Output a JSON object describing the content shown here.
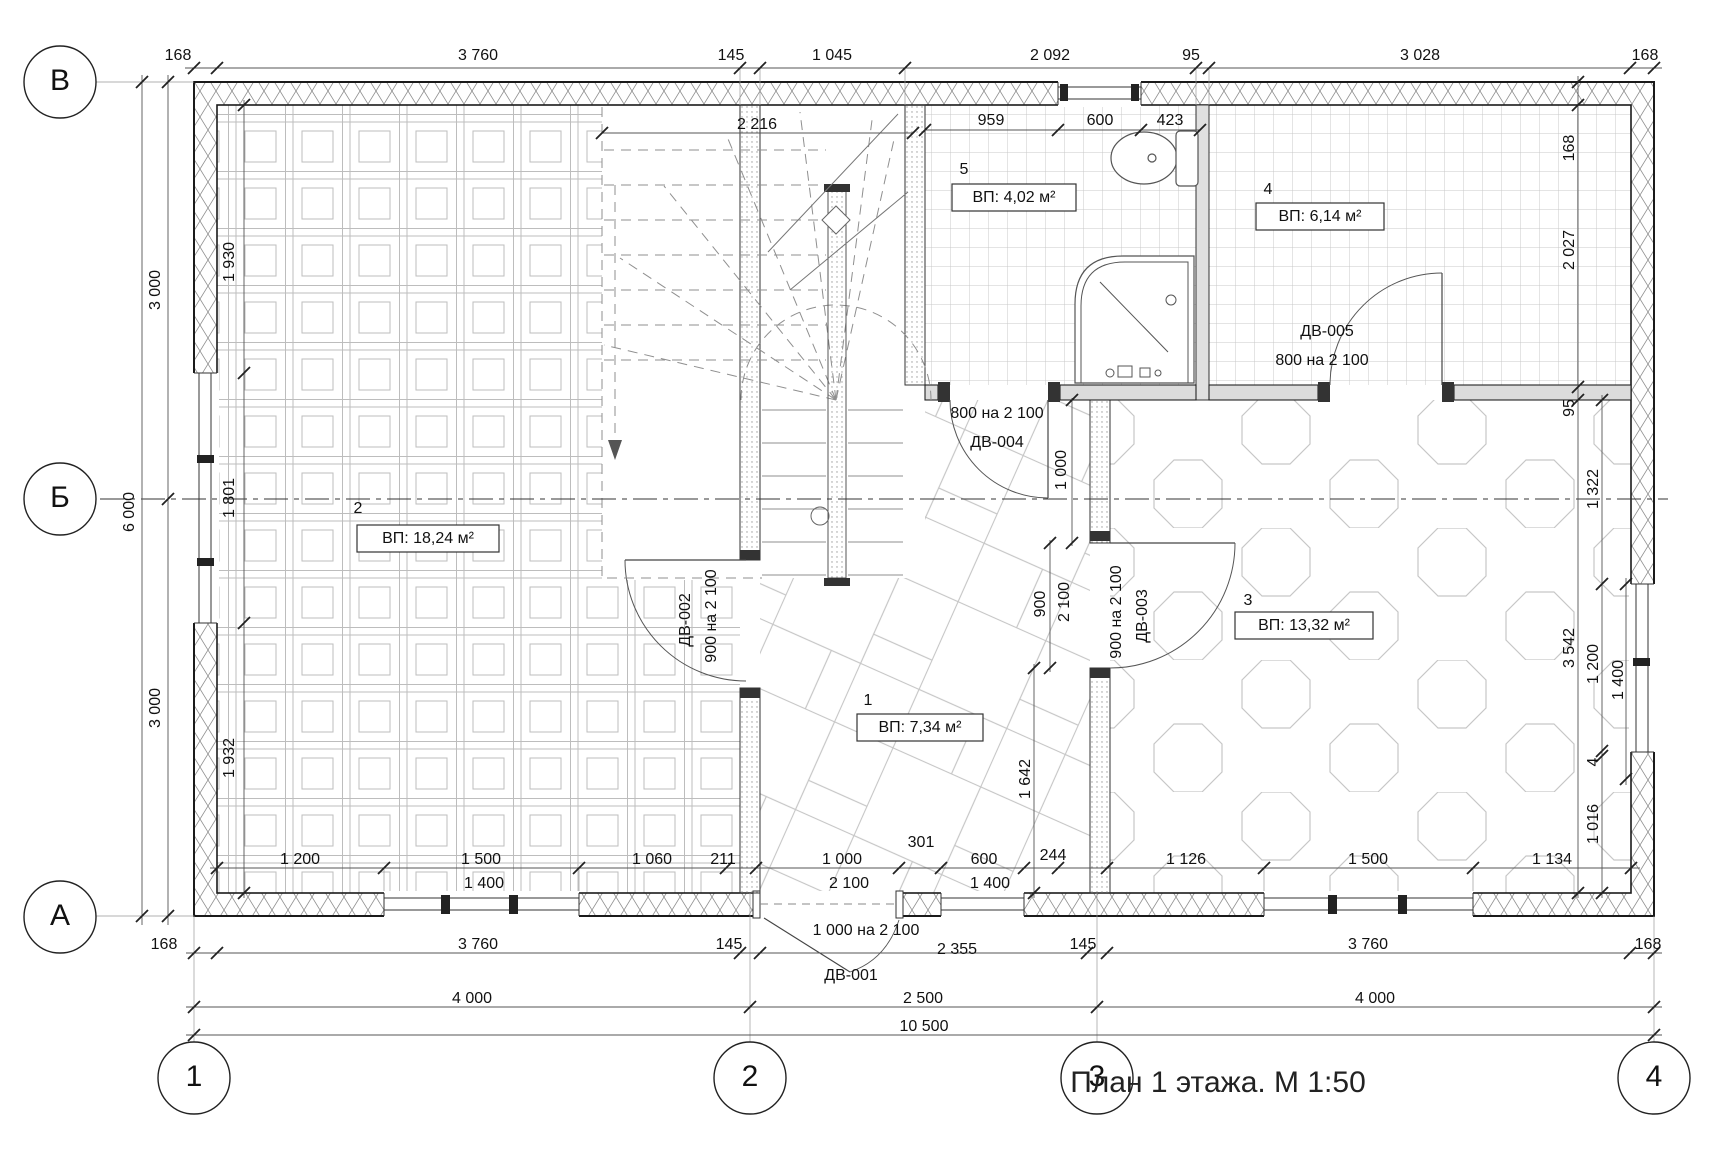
{
  "title": {
    "text": "План 1 этажа. М 1:50"
  },
  "grid": {
    "row_axes": [
      "В",
      "Б",
      "А"
    ],
    "col_axes": [
      "1",
      "2",
      "3",
      "4"
    ],
    "spans": {
      "1-2": "4 000",
      "2-3": "2 500",
      "3-4": "4 000",
      "total": "10 500",
      "В-Б": "3 000",
      "Б-А": "3 000",
      "В-А": "6 000"
    }
  },
  "rooms": [
    {
      "number": "1",
      "area": "ВП: 7,34 м²"
    },
    {
      "number": "2",
      "area": "ВП: 18,24 м²"
    },
    {
      "number": "3",
      "area": "ВП: 13,32 м²"
    },
    {
      "number": "4",
      "area": "ВП: 6,14 м²"
    },
    {
      "number": "5",
      "area": "ВП: 4,02 м²"
    }
  ],
  "doors": [
    {
      "id": "ДВ-001",
      "size": "1 000 на 2 100"
    },
    {
      "id": "ДВ-002",
      "size": "900 на 2 100"
    },
    {
      "id": "ДВ-003",
      "size": "900 на 2 100"
    },
    {
      "id": "ДВ-004",
      "size": "800 на 2 100"
    },
    {
      "id": "ДВ-005",
      "size": "800 на 2 100"
    }
  ],
  "colors": {
    "line": "#1a1a1a",
    "dim": "#555555",
    "pattern": "#c8c8c8",
    "wall_fill": "#dcdcdc"
  },
  "labels": [
    {
      "n": "grid-bubble-v",
      "t": "В",
      "x": 60,
      "y": 82,
      "circle": true
    },
    {
      "n": "grid-bubble-b",
      "t": "Б",
      "x": 60,
      "y": 499,
      "circle": true
    },
    {
      "n": "grid-bubble-a",
      "t": "А",
      "x": 60,
      "y": 917,
      "circle": true
    },
    {
      "n": "grid-bubble-1",
      "t": "1",
      "x": 194,
      "y": 1078,
      "circle": true
    },
    {
      "n": "grid-bubble-2",
      "t": "2",
      "x": 750,
      "y": 1078,
      "circle": true
    },
    {
      "n": "grid-bubble-3",
      "t": "3",
      "x": 1097,
      "y": 1078,
      "circle": true
    },
    {
      "n": "grid-bubble-4",
      "t": "4",
      "x": 1654,
      "y": 1078,
      "circle": true
    },
    {
      "n": "dim-top",
      "t": "168",
      "x": 178,
      "y": 56
    },
    {
      "n": "dim-top",
      "t": "3 760",
      "x": 478,
      "y": 56
    },
    {
      "n": "dim-top",
      "t": "145",
      "x": 731,
      "y": 56
    },
    {
      "n": "dim-top",
      "t": "1 045",
      "x": 832,
      "y": 56
    },
    {
      "n": "dim-top",
      "t": "2 092",
      "x": 1050,
      "y": 56
    },
    {
      "n": "dim-top",
      "t": "95",
      "x": 1191,
      "y": 56
    },
    {
      "n": "dim-top",
      "t": "3 028",
      "x": 1420,
      "y": 56
    },
    {
      "n": "dim-top",
      "t": "168",
      "x": 1645,
      "y": 56
    },
    {
      "n": "dim-left",
      "t": "3 000",
      "x": 156,
      "y": 290,
      "r": 1
    },
    {
      "n": "dim-left",
      "t": "6 000",
      "x": 130,
      "y": 512,
      "r": 1
    },
    {
      "n": "dim-left",
      "t": "3 000",
      "x": 156,
      "y": 708,
      "r": 1
    },
    {
      "n": "dim-left-inner",
      "t": "1 930",
      "x": 230,
      "y": 262,
      "r": 1
    },
    {
      "n": "dim-left-inner",
      "t": "1 801",
      "x": 230,
      "y": 498,
      "r": 1
    },
    {
      "n": "dim-left-inner",
      "t": "1 932",
      "x": 230,
      "y": 758,
      "r": 1
    },
    {
      "n": "dim-right",
      "t": "168",
      "x": 1570,
      "y": 148,
      "r": 1
    },
    {
      "n": "dim-right",
      "t": "2 027",
      "x": 1570,
      "y": 250,
      "r": 1
    },
    {
      "n": "dim-right",
      "t": "95",
      "x": 1570,
      "y": 408,
      "r": 1
    },
    {
      "n": "dim-right",
      "t": "3 542",
      "x": 1570,
      "y": 648,
      "r": 1
    },
    {
      "n": "dim-right",
      "t": "1 322",
      "x": 1594,
      "y": 489,
      "r": 1
    },
    {
      "n": "dim-right",
      "t": "1 200",
      "x": 1594,
      "y": 664,
      "r": 1
    },
    {
      "n": "dim-right",
      "t": "1 400",
      "x": 1619,
      "y": 680,
      "r": 1
    },
    {
      "n": "dim-right",
      "t": "4",
      "x": 1594,
      "y": 762,
      "r": 1
    },
    {
      "n": "dim-right",
      "t": "1 016",
      "x": 1594,
      "y": 824,
      "r": 1
    },
    {
      "n": "dim-bath",
      "t": "959",
      "x": 991,
      "y": 121
    },
    {
      "n": "dim-bath",
      "t": "600",
      "x": 1100,
      "y": 121
    },
    {
      "n": "dim-bath",
      "t": "423",
      "x": 1170,
      "y": 121
    },
    {
      "n": "dim-stairs",
      "t": "2 216",
      "x": 757,
      "y": 125
    },
    {
      "n": "dim-corridor",
      "t": "1 000",
      "x": 1062,
      "y": 470,
      "r": 1
    },
    {
      "n": "dim-door3",
      "t": "900",
      "x": 1041,
      "y": 604,
      "r": 1
    },
    {
      "n": "dim-door3",
      "t": "2 100",
      "x": 1065,
      "y": 602,
      "r": 1
    },
    {
      "n": "dim-hall",
      "t": "1 642",
      "x": 1026,
      "y": 779,
      "r": 1
    },
    {
      "n": "door-label-dv002",
      "t": "ДВ-002",
      "x": 686,
      "y": 620,
      "r": 1
    },
    {
      "n": "door-size-dv002",
      "t": "900 на 2 100",
      "x": 712,
      "y": 616,
      "r": 1
    },
    {
      "n": "door-size-dv003",
      "t": "900 на 2 100",
      "x": 1117,
      "y": 612,
      "r": 1
    },
    {
      "n": "door-label-dv003",
      "t": "ДВ-003",
      "x": 1143,
      "y": 616,
      "r": 1
    },
    {
      "n": "door-size-dv004",
      "t": "800 на 2 100",
      "x": 997,
      "y": 414
    },
    {
      "n": "door-label-dv004",
      "t": "ДВ-004",
      "x": 997,
      "y": 443
    },
    {
      "n": "door-label-dv005",
      "t": "ДВ-005",
      "x": 1327,
      "y": 332
    },
    {
      "n": "door-size-dv005",
      "t": "800 на 2 100",
      "x": 1322,
      "y": 361
    },
    {
      "n": "door-size-dv001",
      "t": "1 000 на 2 100",
      "x": 866,
      "y": 931
    },
    {
      "n": "door-label-dv001",
      "t": "ДВ-001",
      "x": 851,
      "y": 976
    },
    {
      "n": "dim-bottom1",
      "t": "1 200",
      "x": 300,
      "y": 860
    },
    {
      "n": "dim-bottom1",
      "t": "1 500",
      "x": 481,
      "y": 860
    },
    {
      "n": "dim-bottom1",
      "t": "1 400",
      "x": 484,
      "y": 884
    },
    {
      "n": "dim-bottom1",
      "t": "1 060",
      "x": 652,
      "y": 860
    },
    {
      "n": "dim-bottom1",
      "t": "211",
      "x": 723,
      "y": 860
    },
    {
      "n": "dim-bottom1",
      "t": "1 000",
      "x": 842,
      "y": 860
    },
    {
      "n": "dim-bottom1",
      "t": "2 100",
      "x": 849,
      "y": 884
    },
    {
      "n": "dim-bottom1",
      "t": "301",
      "x": 921,
      "y": 843
    },
    {
      "n": "dim-bottom1",
      "t": "600",
      "x": 984,
      "y": 860
    },
    {
      "n": "dim-bottom1",
      "t": "1 400",
      "x": 990,
      "y": 884
    },
    {
      "n": "dim-bottom1",
      "t": "244",
      "x": 1053,
      "y": 856
    },
    {
      "n": "dim-bottom1",
      "t": "1 126",
      "x": 1186,
      "y": 860
    },
    {
      "n": "dim-bottom1",
      "t": "1 500",
      "x": 1368,
      "y": 860
    },
    {
      "n": "dim-bottom1",
      "t": "1 134",
      "x": 1552,
      "y": 860
    },
    {
      "n": "dim-bottom2",
      "t": "168",
      "x": 164,
      "y": 945
    },
    {
      "n": "dim-bottom2",
      "t": "3 760",
      "x": 478,
      "y": 945
    },
    {
      "n": "dim-bottom2",
      "t": "145",
      "x": 729,
      "y": 945
    },
    {
      "n": "dim-bottom2",
      "t": "2 355",
      "x": 957,
      "y": 950
    },
    {
      "n": "dim-bottom2",
      "t": "145",
      "x": 1083,
      "y": 945
    },
    {
      "n": "dim-bottom2",
      "t": "3 760",
      "x": 1368,
      "y": 945
    },
    {
      "n": "dim-bottom2",
      "t": "168",
      "x": 1648,
      "y": 945
    },
    {
      "n": "dim-bottom3",
      "t": "4 000",
      "x": 472,
      "y": 999
    },
    {
      "n": "dim-bottom3",
      "t": "2 500",
      "x": 923,
      "y": 999
    },
    {
      "n": "dim-bottom3",
      "t": "4 000",
      "x": 1375,
      "y": 999
    },
    {
      "n": "dim-bottom4",
      "t": "10 500",
      "x": 924,
      "y": 1027
    },
    {
      "n": "room-number-2",
      "t": "2",
      "x": 358,
      "y": 509
    },
    {
      "n": "room-area-2",
      "t": "ВП: 18,24 м²",
      "x": 428,
      "y": 539,
      "box": 142
    },
    {
      "n": "room-number-1",
      "t": "1",
      "x": 868,
      "y": 701
    },
    {
      "n": "room-area-1",
      "t": "ВП: 7,34 м²",
      "x": 920,
      "y": 728,
      "box": 126
    },
    {
      "n": "room-number-3",
      "t": "3",
      "x": 1248,
      "y": 601
    },
    {
      "n": "room-area-3",
      "t": "ВП: 13,32 м²",
      "x": 1304,
      "y": 626,
      "box": 138
    },
    {
      "n": "room-number-4",
      "t": "4",
      "x": 1268,
      "y": 190
    },
    {
      "n": "room-area-4",
      "t": "ВП: 6,14 м²",
      "x": 1320,
      "y": 217,
      "box": 128
    },
    {
      "n": "room-number-5",
      "t": "5",
      "x": 964,
      "y": 170
    },
    {
      "n": "room-area-5",
      "t": "ВП: 4,02 м²",
      "x": 1014,
      "y": 198,
      "box": 124
    }
  ]
}
